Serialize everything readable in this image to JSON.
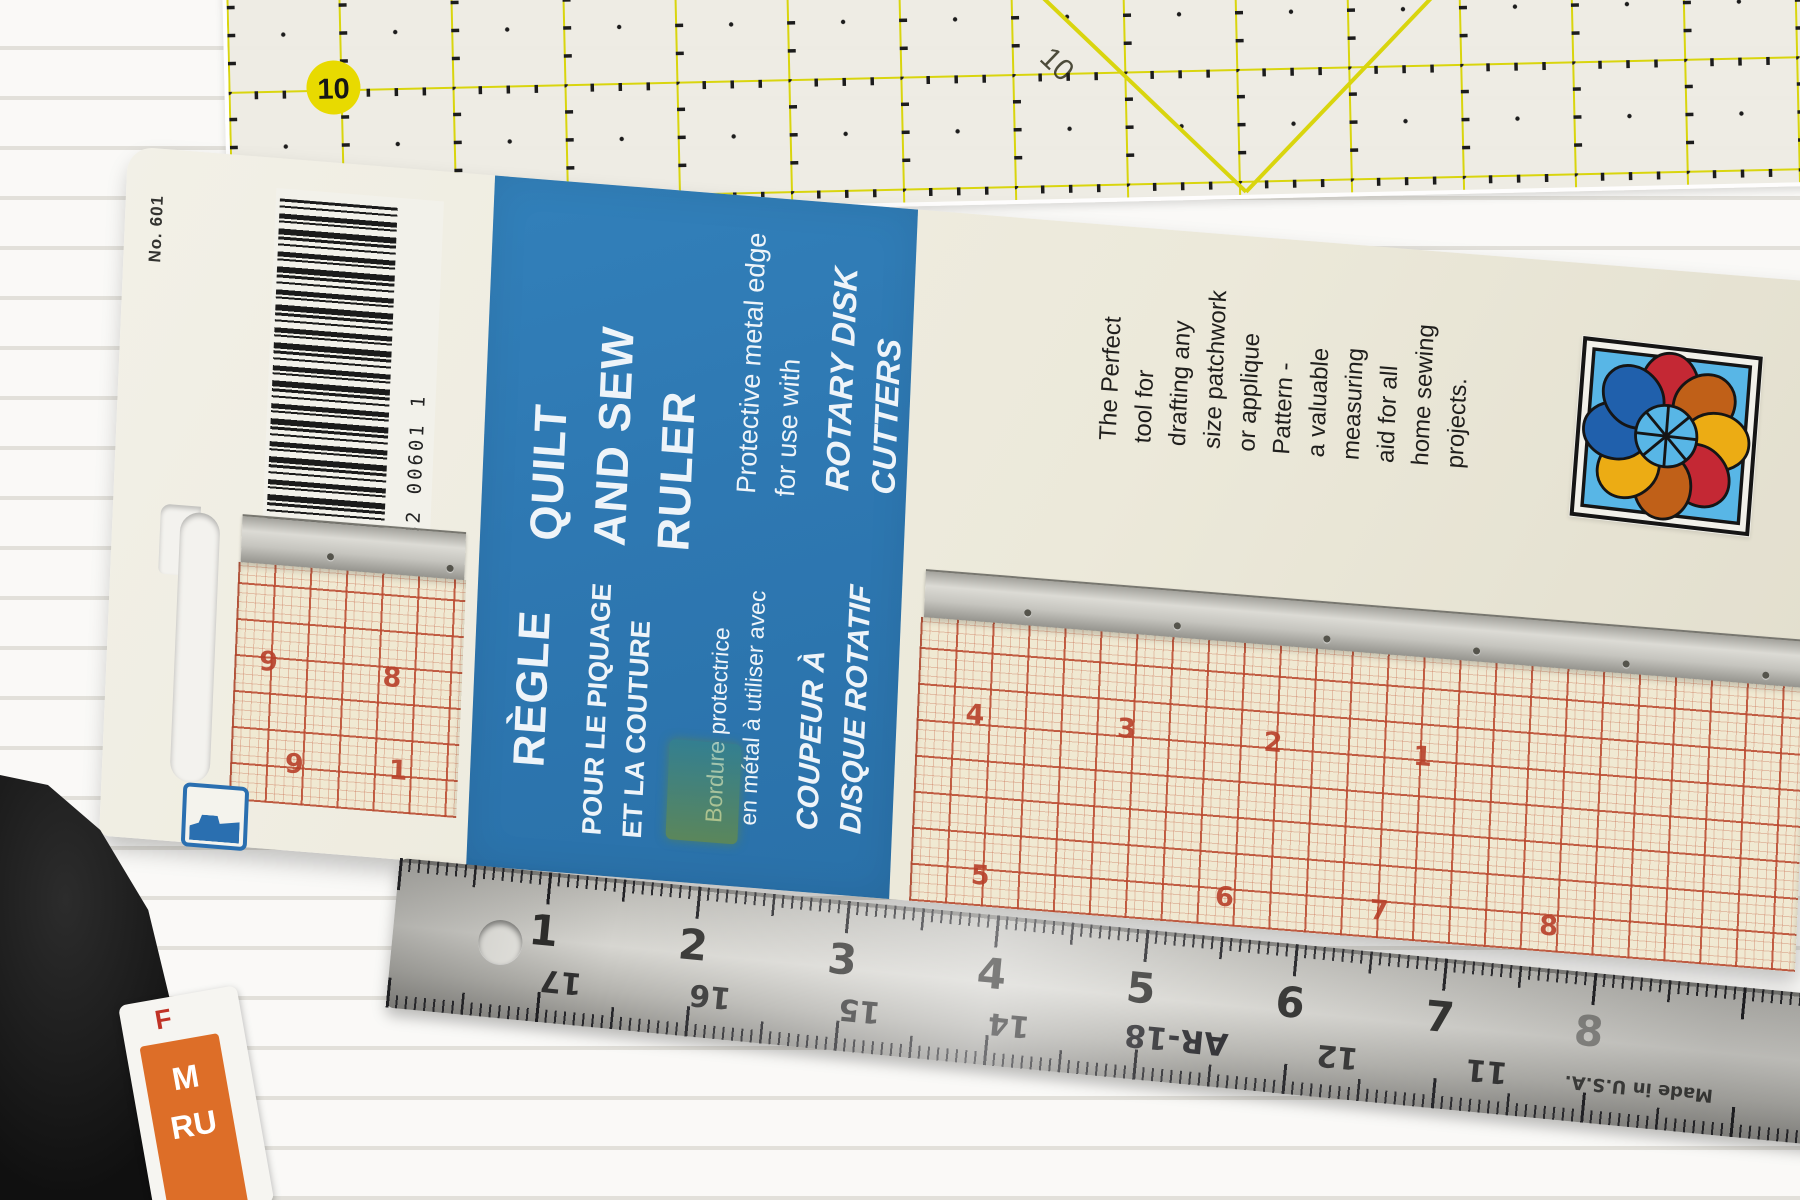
{
  "package": {
    "product_no": "No. 601",
    "barcode_number": "0 62532 00601 1",
    "blue_panel": {
      "title_en": "QUILT\nAND SEW\nRULER",
      "feature_en": "Protective metal edge\nfor use with",
      "cutter_en": "ROTARY DISK\nCUTTERS",
      "title_fr": "RÈGLE",
      "title_fr_lines": "POUR LE PIQUAGE\nET LA COUTURE",
      "feature_fr": "Bordure protectrice\nen métal à utiliser avec",
      "cutter_fr": "COUPEUR À\nDISQUE ROTATIF"
    },
    "description_en": "The Perfect\ntool for\ndrafting any\nsize patchwork\nor applique\nPattern -\na valuable\nmeasuring\naid for all\nhome sewing\nprojects.",
    "description_fr": "L'outil idéal\npour dessiner\nun patchwork\nde n'importe\nquelle\ngrandeur ou\nun patron -\nUne aide\nprécieuse\npour tous les\nprojets de\ncouture."
  },
  "ruler_left_window": {
    "top_numbers": [
      "9",
      "8"
    ],
    "lower_numbers": [
      "9",
      "1"
    ]
  },
  "ruler_right_window": {
    "top_numbers": [
      "4",
      "3",
      "2",
      "1"
    ],
    "bottom_numbers": [
      "5",
      "6",
      "7",
      "8"
    ]
  },
  "yellow_mat_ruler": {
    "circle_label": "10",
    "diagonal_label": "10"
  },
  "steel_ruler": {
    "top_numbers": [
      "1",
      "2",
      "3",
      "4",
      "5",
      "6",
      "7",
      "8"
    ],
    "bottom_numbers": [
      "17",
      "16",
      "15",
      "14",
      "12",
      "11"
    ],
    "model": "AR-18",
    "made_in": "Made in U.S.A."
  },
  "corner_package": {
    "red_letter": "F",
    "white_letters": "M\nRU"
  },
  "colors": {
    "panel_blue": "#2e78b2",
    "card_cream": "#ece9da",
    "grid_red": "#bf4a30",
    "mat_yellow": "#d9d50e",
    "logo_bg_blue": "#58b6e6",
    "petal_red": "#c42834",
    "petal_orange": "#c06018",
    "petal_yellow": "#ecac14",
    "petal_blue": "#2060ac"
  }
}
